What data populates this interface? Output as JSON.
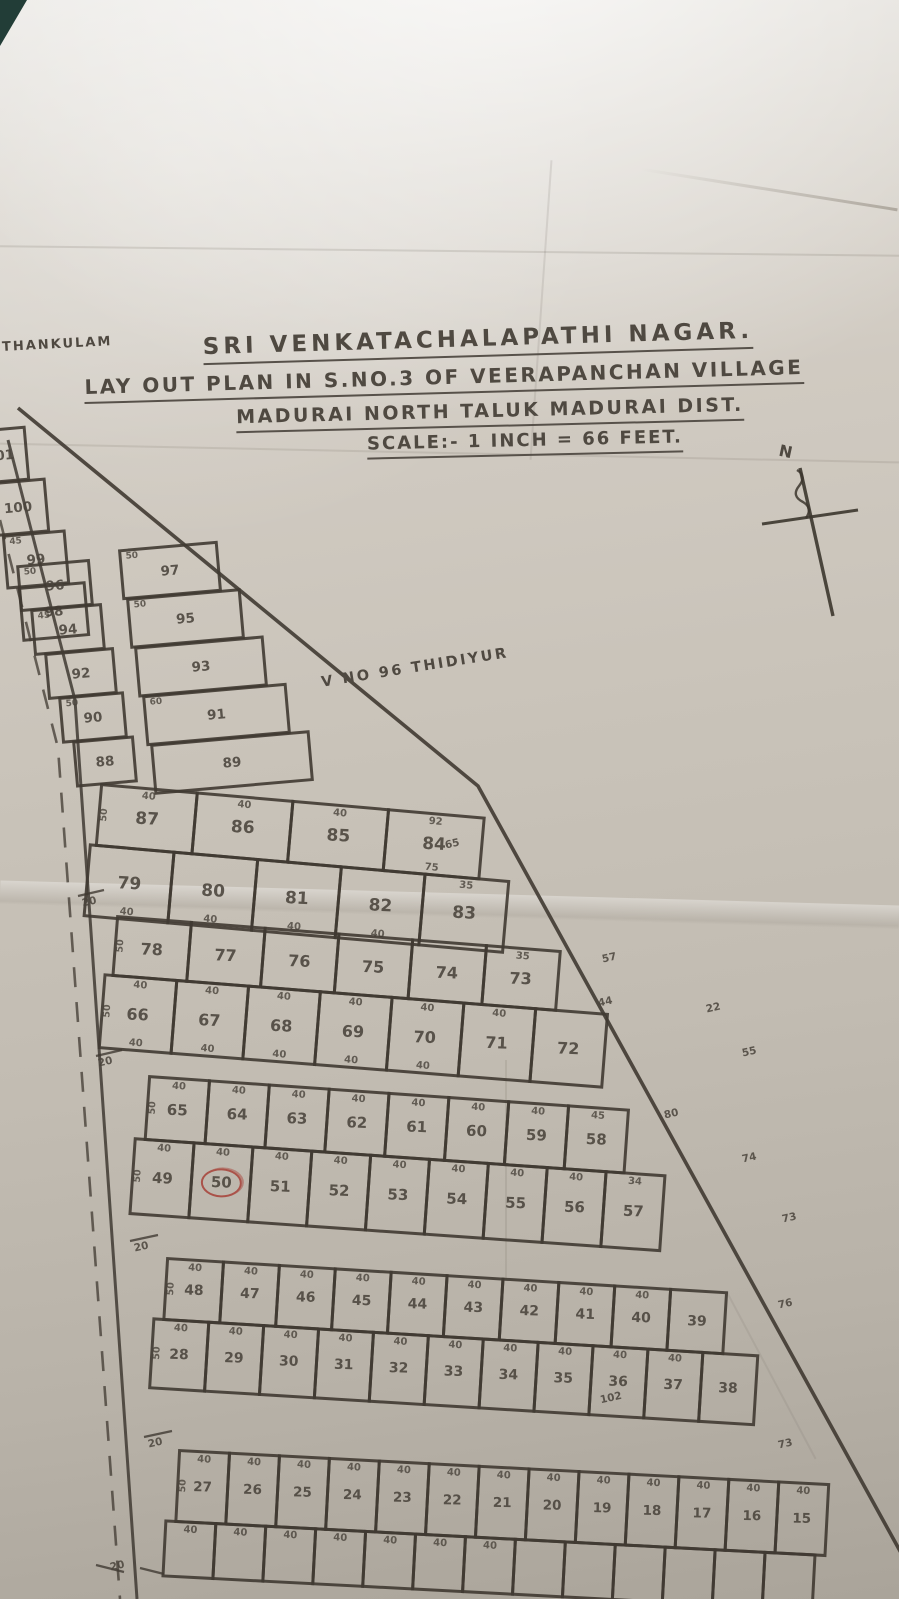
{
  "photo": {
    "paper_color": "#c9c3b9",
    "ink_color": "#4a443c",
    "red_ink": "#a8453c",
    "table_corner_color": "#223d37"
  },
  "header": {
    "place_label": "THANKULAM",
    "title": "SRI VENKATACHALAPATHI NAGAR.",
    "subtitle": "LAY OUT PLAN IN S.NO.3 OF VEERAPANCHAN VILLAGE",
    "district_line": "MADURAI NORTH TALUK MADURAI DIST.",
    "scale_line": "SCALE:- 1 INCH = 66 FEET."
  },
  "annotations": {
    "north_label": "N",
    "village_note": "V NO 96 THIDIYUR",
    "circled_plot": "50"
  },
  "strip": {
    "singles": {
      "plots": [
        "101",
        "100",
        "99",
        "98"
      ],
      "dims": [
        "40",
        "",
        "45",
        ""
      ]
    },
    "west": {
      "plots": [
        "96",
        "94",
        "92",
        "90",
        "88"
      ],
      "dims": [
        "50",
        "45",
        "",
        "50",
        ""
      ]
    },
    "east": {
      "plots": [
        "97",
        "95",
        "93",
        "91",
        "89"
      ],
      "dims": [
        "50",
        "50",
        "",
        "60",
        ""
      ]
    }
  },
  "blocks": [
    {
      "id": "A",
      "corner_dim": "20",
      "edge_dims": [
        "65"
      ],
      "rows": [
        {
          "left_dim": "50",
          "plots": [
            "87",
            "86",
            "85",
            "84"
          ],
          "top_dims": [
            "40",
            "40",
            "40",
            "92"
          ],
          "bottom_dims": [
            "",
            "",
            "",
            "75"
          ]
        },
        {
          "left_dim": "",
          "plots": [
            "79",
            "80",
            "81",
            "82",
            "83"
          ],
          "top_dims": [
            "",
            "",
            "",
            "",
            "35"
          ],
          "bottom_dims": [
            "40",
            "40",
            "40",
            "40",
            ""
          ]
        }
      ]
    },
    {
      "id": "B",
      "corner_dim": "20",
      "edge_dims": [
        "57",
        "44",
        "22",
        "55"
      ],
      "rows": [
        {
          "left_dim": "50",
          "plots": [
            "78",
            "77",
            "76",
            "75",
            "74",
            "73"
          ],
          "top_dims": [
            "",
            "",
            "",
            "",
            "",
            "35"
          ],
          "bottom_dims": [
            "",
            "",
            "",
            "",
            "",
            ""
          ]
        },
        {
          "left_dim": "50",
          "plots": [
            "66",
            "67",
            "68",
            "69",
            "70",
            "71",
            "72"
          ],
          "top_dims": [
            "40",
            "40",
            "40",
            "40",
            "40",
            "40",
            ""
          ],
          "bottom_dims": [
            "40",
            "40",
            "40",
            "40",
            "40",
            "",
            ""
          ]
        }
      ]
    },
    {
      "id": "C",
      "corner_dim": "20",
      "edge_dims": [
        "80",
        "74",
        "73"
      ],
      "rows": [
        {
          "left_dim": "50",
          "plots": [
            "65",
            "64",
            "63",
            "62",
            "61",
            "60",
            "59",
            "58"
          ],
          "top_dims": [
            "40",
            "40",
            "40",
            "40",
            "40",
            "40",
            "40",
            "45"
          ],
          "bottom_dims": [
            "",
            "",
            "",
            "",
            "",
            "",
            "",
            ""
          ]
        },
        {
          "left_dim": "50",
          "plots": [
            "49",
            "50",
            "51",
            "52",
            "53",
            "54",
            "55",
            "56",
            "57"
          ],
          "top_dims": [
            "40",
            "40",
            "40",
            "40",
            "40",
            "40",
            "40",
            "40",
            "34"
          ],
          "bottom_dims": [
            "",
            "",
            "",
            "",
            "",
            "",
            "",
            "",
            ""
          ]
        }
      ]
    },
    {
      "id": "D",
      "corner_dim": "20",
      "edge_dims": [
        "76",
        "102"
      ],
      "rows": [
        {
          "left_dim": "50",
          "plots": [
            "48",
            "47",
            "46",
            "45",
            "44",
            "43",
            "42",
            "41",
            "40",
            "39"
          ],
          "top_dims": [
            "40",
            "40",
            "40",
            "40",
            "40",
            "40",
            "40",
            "40",
            "40",
            ""
          ],
          "bottom_dims": [
            "",
            "",
            "",
            "",
            "",
            "",
            "",
            "",
            "",
            ""
          ]
        },
        {
          "left_dim": "50",
          "plots": [
            "28",
            "29",
            "30",
            "31",
            "32",
            "33",
            "34",
            "35",
            "36",
            "37",
            "38"
          ],
          "top_dims": [
            "40",
            "40",
            "40",
            "40",
            "40",
            "40",
            "40",
            "40",
            "40",
            "40",
            ""
          ],
          "bottom_dims": [
            "",
            "",
            "",
            "",
            "",
            "",
            "",
            "",
            "",
            "",
            ""
          ]
        }
      ]
    },
    {
      "id": "E",
      "corner_dim": "20",
      "edge_dims": [
        "73"
      ],
      "rows": [
        {
          "left_dim": "50",
          "plots": [
            "27",
            "26",
            "25",
            "24",
            "23",
            "22",
            "21",
            "20",
            "19",
            "18",
            "17",
            "16",
            "15"
          ],
          "top_dims": [
            "40",
            "40",
            "40",
            "40",
            "40",
            "40",
            "40",
            "40",
            "40",
            "40",
            "40",
            "40",
            "40"
          ],
          "bottom_dims": [
            "",
            "",
            "",
            "",
            "",
            "",
            "",
            "",
            "",
            "",
            "",
            "",
            ""
          ]
        },
        {
          "left_dim": "",
          "plots": [
            "",
            "",
            "",
            "",
            "",
            "",
            "",
            "",
            "",
            "",
            "",
            "",
            ""
          ],
          "top_dims": [
            "40",
            "40",
            "40",
            "40",
            "40",
            "40",
            "40",
            "",
            "",
            "",
            "",
            "",
            ""
          ],
          "bottom_dims": [
            "",
            "",
            "",
            "",
            "",
            "",
            "",
            "",
            "",
            "",
            "",
            "",
            ""
          ]
        }
      ]
    }
  ]
}
